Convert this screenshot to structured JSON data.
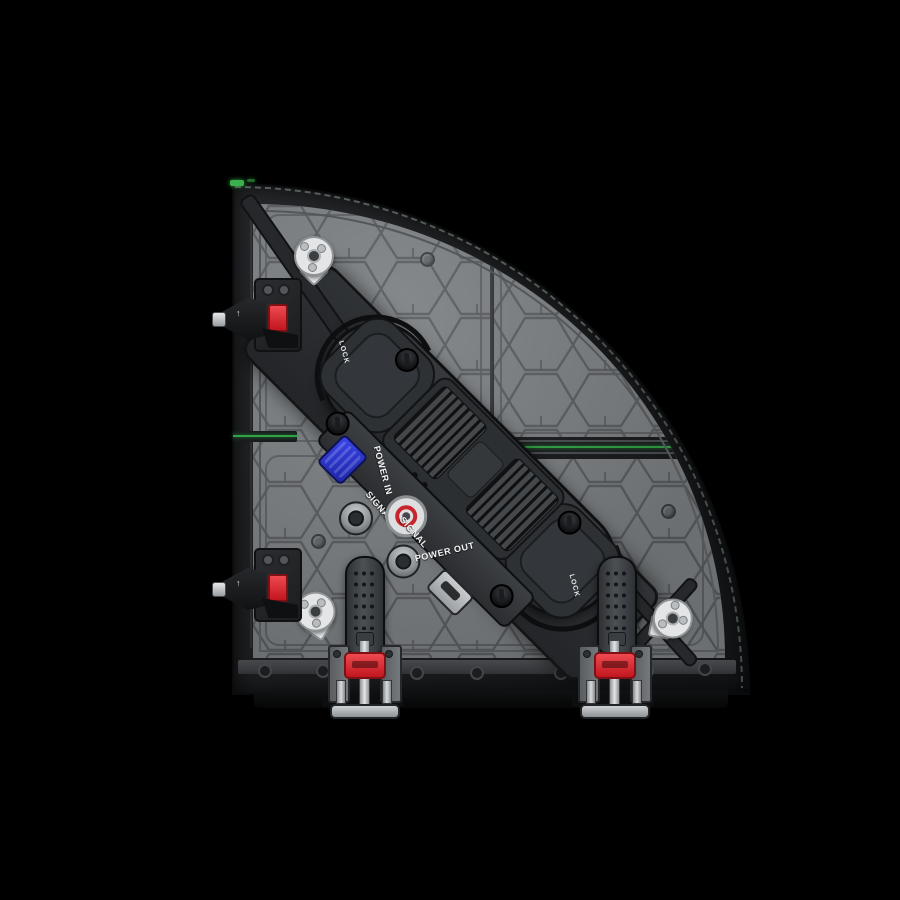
{
  "scene": {
    "type": "product-photo",
    "subject": "Quarter-circle curved LED display panel, rear view",
    "background_color": "#000000"
  },
  "panel": {
    "face_color": "#7d8184",
    "rim_color": "#1b1d1f",
    "accent_green": "#2fa345",
    "texture": "honeycomb"
  },
  "hub": {
    "lock_left": "LOCK",
    "lock_right": "LOCK",
    "labels": {
      "power_in": "POWER IN",
      "signal_1": "SIGNAL",
      "signal_2": "SIGNAL",
      "power_out": "POWER OUT"
    },
    "power_in_connector_color": "#2731cf",
    "button_ring_color": "#c8242b"
  },
  "hardware": {
    "clamp_knob_color": "#d5232e",
    "side_latch_color": "#d5232e"
  },
  "icons": {
    "arrow_up": "↑"
  }
}
